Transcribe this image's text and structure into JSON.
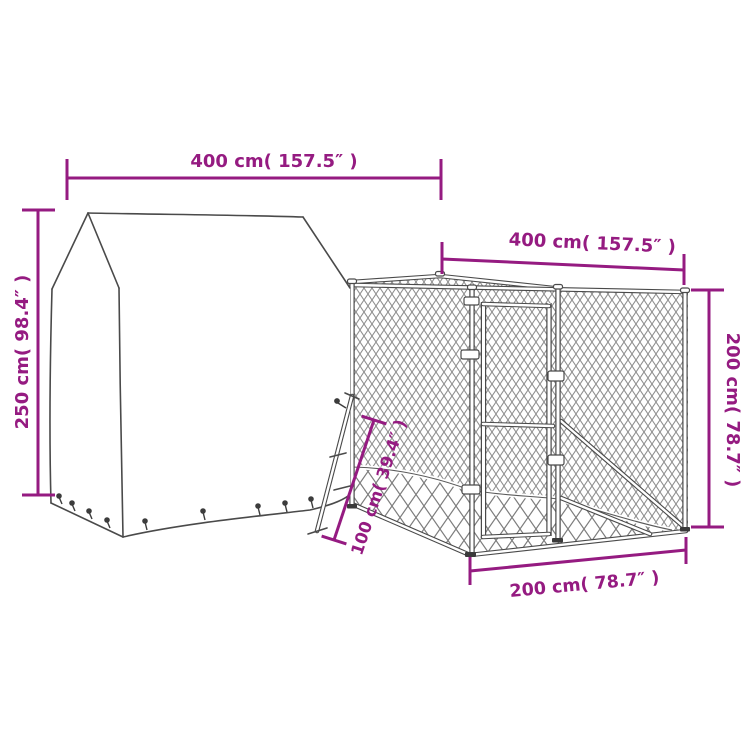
{
  "diagram": {
    "subject": "dog kennel with cover dimension drawing",
    "dimensions": {
      "top_left": "400 cm( 157.5″ )",
      "top_right": "400 cm( 157.5″ )",
      "left": "250 cm( 98.4″ )",
      "right": "200 cm( 78.7″ )",
      "bottom": "200 cm( 78.7″ )",
      "diagonal": "100 cm( 39.4″ )"
    },
    "colors": {
      "dimension_accent": "#951b81",
      "drawing_line": "#4a4a4a",
      "mesh_small": "#8f8f8f",
      "mesh_large": "#7d7d7d",
      "background": "#ffffff"
    }
  }
}
